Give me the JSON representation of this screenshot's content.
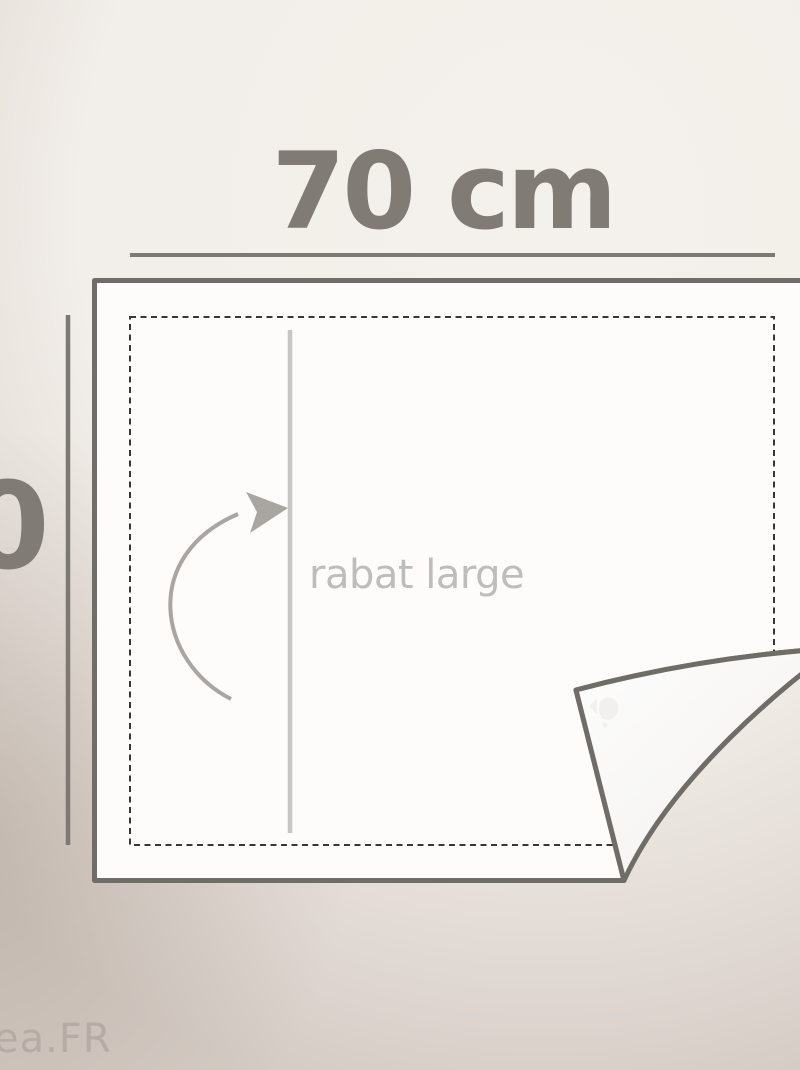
{
  "labels": {
    "width": "70 cm",
    "height_partial": "0",
    "flap": "rabat large"
  },
  "watermark": {
    "site": "ea.FR"
  },
  "colors": {
    "background_top": "#f4f1ec",
    "background_bottom": "#cdc3bb",
    "sheet_fill": "#fdfcfa",
    "sheet_border": "#706d69",
    "dimension_line": "#7c7974",
    "dimension_label": "#817b76",
    "hem_dash": "#3a3836",
    "fold_line": "#c7c6c5",
    "flap_label": "#bdbdbd",
    "arrow": "#a9a5a1",
    "site_watermark": "#b3a6a1"
  }
}
